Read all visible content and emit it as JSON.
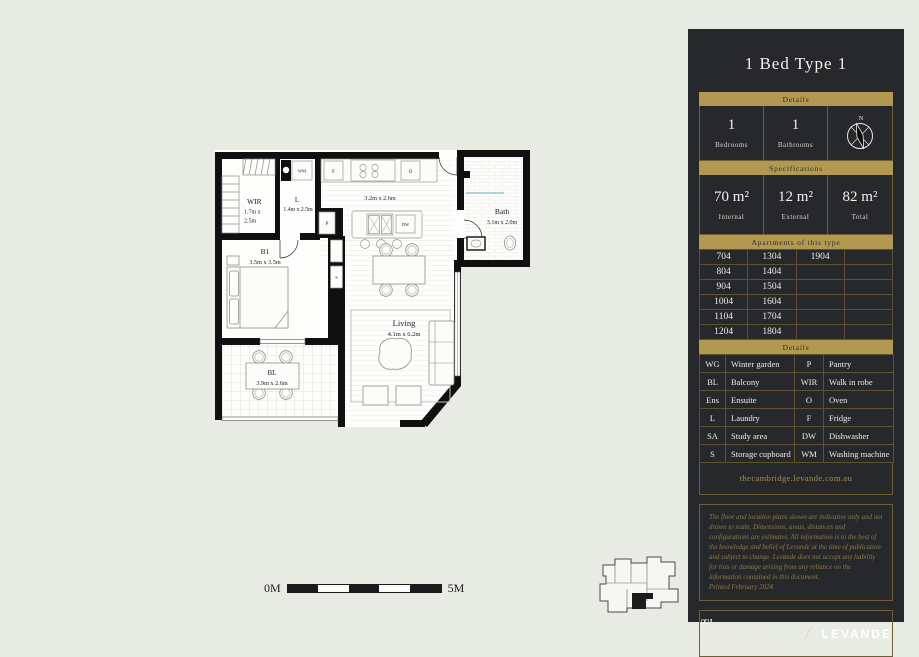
{
  "page": {
    "background": "#e8ebe4"
  },
  "panel": {
    "background": "#26282b",
    "gold": "#b3984f",
    "title": "1 Bed Type 1",
    "details_header": "Details",
    "details": {
      "bedrooms_value": "1",
      "bedrooms_label": "Bedrooms",
      "bathrooms_value": "1",
      "bathrooms_label": "Bathrooms",
      "compass_label": "N"
    },
    "specs_header": "Specifications",
    "specs": [
      {
        "value": "70 m²",
        "label": "Internal"
      },
      {
        "value": "12 m²",
        "label": "External"
      },
      {
        "value": "82 m²",
        "label": "Total"
      }
    ],
    "apartments_header": "Apartments of this type",
    "apartments_rows": [
      [
        "704",
        "1304",
        "1904",
        ""
      ],
      [
        "804",
        "1404",
        "",
        ""
      ],
      [
        "904",
        "1504",
        "",
        ""
      ],
      [
        "1004",
        "1604",
        "",
        ""
      ],
      [
        "1104",
        "1704",
        "",
        ""
      ],
      [
        "1204",
        "1804",
        "",
        ""
      ]
    ],
    "legend_header": "Details",
    "legend_rows": [
      [
        "WG",
        "Winter garden",
        "P",
        "Pantry"
      ],
      [
        "BL",
        "Balcony",
        "WIR",
        "Walk in robe"
      ],
      [
        "Ens",
        "Ensuite",
        "O",
        "Oven"
      ],
      [
        "L",
        "Laundry",
        "F",
        "Fridge"
      ],
      [
        "SA",
        "Study area",
        "DW",
        "Dishwasher"
      ],
      [
        "S",
        "Storage cupboard",
        "WM",
        "Washing machine"
      ]
    ],
    "website": "thecambridge.levande.com.au",
    "disclaimer": "The floor and location plans shown are indicative only and not drawn to scale. Dimensions, areas, distances and configurations are estimates. All information is to the best of the knowledge and belief of Levande at the time of publication and subject to change. Levande does not accept any liability for loss or damage arising from any reliance on the information contained in this document.",
    "printed": "Printed February 2024.",
    "brand_left": "The Cambridge",
    "brand_divider": "/",
    "brand_right": "LEVANDE"
  },
  "floorplan": {
    "rooms": {
      "wir": {
        "name": "WIR",
        "dims_line1": "1.7m x",
        "dims_line2": "2.5m"
      },
      "laundry": {
        "name": "L",
        "dims": "1.4m x 2.5m"
      },
      "kitchen": {
        "dims": "3.2m x 2.6m"
      },
      "bath": {
        "name": "Bath",
        "dims": "3.1m x 2.0m"
      },
      "bedroom": {
        "name": "B1",
        "dims": "3.5m x 3.5m"
      },
      "living": {
        "name": "Living",
        "dims": "4.1m x 6.2m"
      },
      "balcony": {
        "name": "BL",
        "dims": "3.9m x 2.6m"
      }
    },
    "tags": {
      "washing_machine": "WM",
      "fridge": "F",
      "oven": "O",
      "pantry": "P",
      "dishwasher": "DW",
      "storage": "S"
    },
    "scale": {
      "left_label": "0M",
      "right_label": "5M"
    }
  }
}
